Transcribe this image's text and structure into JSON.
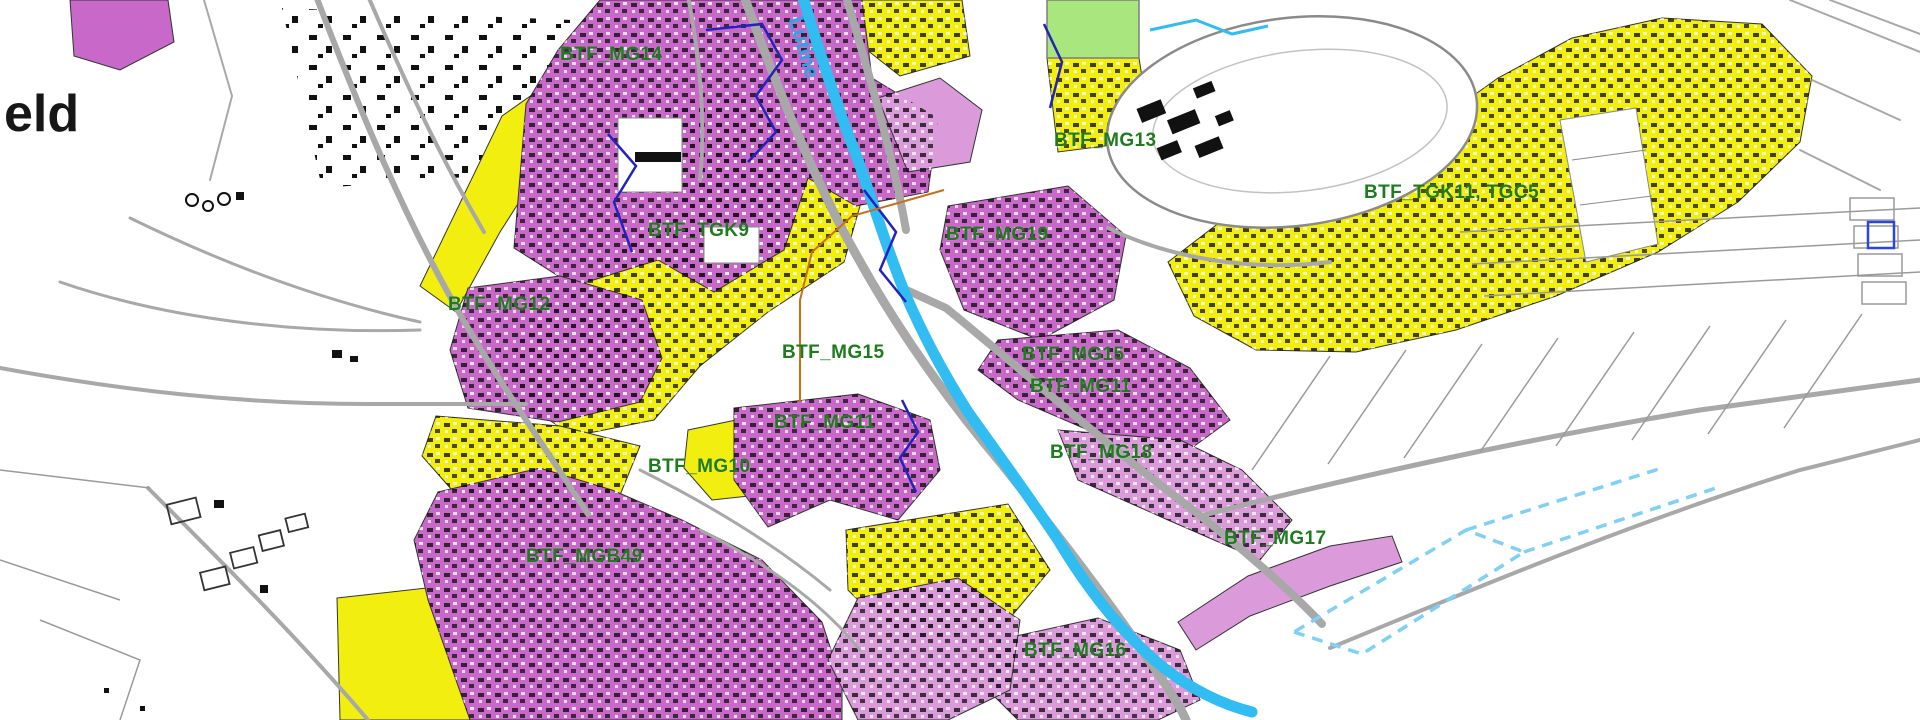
{
  "map": {
    "corner_text": "eld",
    "river_label": "Lutine",
    "labels": [
      {
        "text": "BTF_MG14"
      },
      {
        "text": "BTF_MG13"
      },
      {
        "text": "BTF_TGK11, TGC5"
      },
      {
        "text": "BTF_TGK9"
      },
      {
        "text": "BTF_MG19"
      },
      {
        "text": "BTF_MG12"
      },
      {
        "text": "BTF_MG15"
      },
      {
        "text": "BTF_MG15"
      },
      {
        "text": "BTF_MG11"
      },
      {
        "text": "BTF_MG11"
      },
      {
        "text": "BTF_MG10"
      },
      {
        "text": "BTF_MG18"
      },
      {
        "text": "BTF_MG17"
      },
      {
        "text": "BTF_MGB49"
      },
      {
        "text": "BTF_MG16"
      }
    ]
  },
  "colors": {
    "zone_purple": "#c868c8",
    "zone_purple_light": "#db9bdb",
    "zone_yellow": "#f2ee10",
    "green_area": "#a9e67e",
    "river_blue": "#31bcf2",
    "water_dashed": "#7fd0f7",
    "label_green": "#1e7b1e",
    "road_gray": "#a8a8a8",
    "parcel_gray": "#9a9a9a",
    "navy": "#2323bb",
    "orange": "#c87018",
    "text_black": "#161616"
  }
}
